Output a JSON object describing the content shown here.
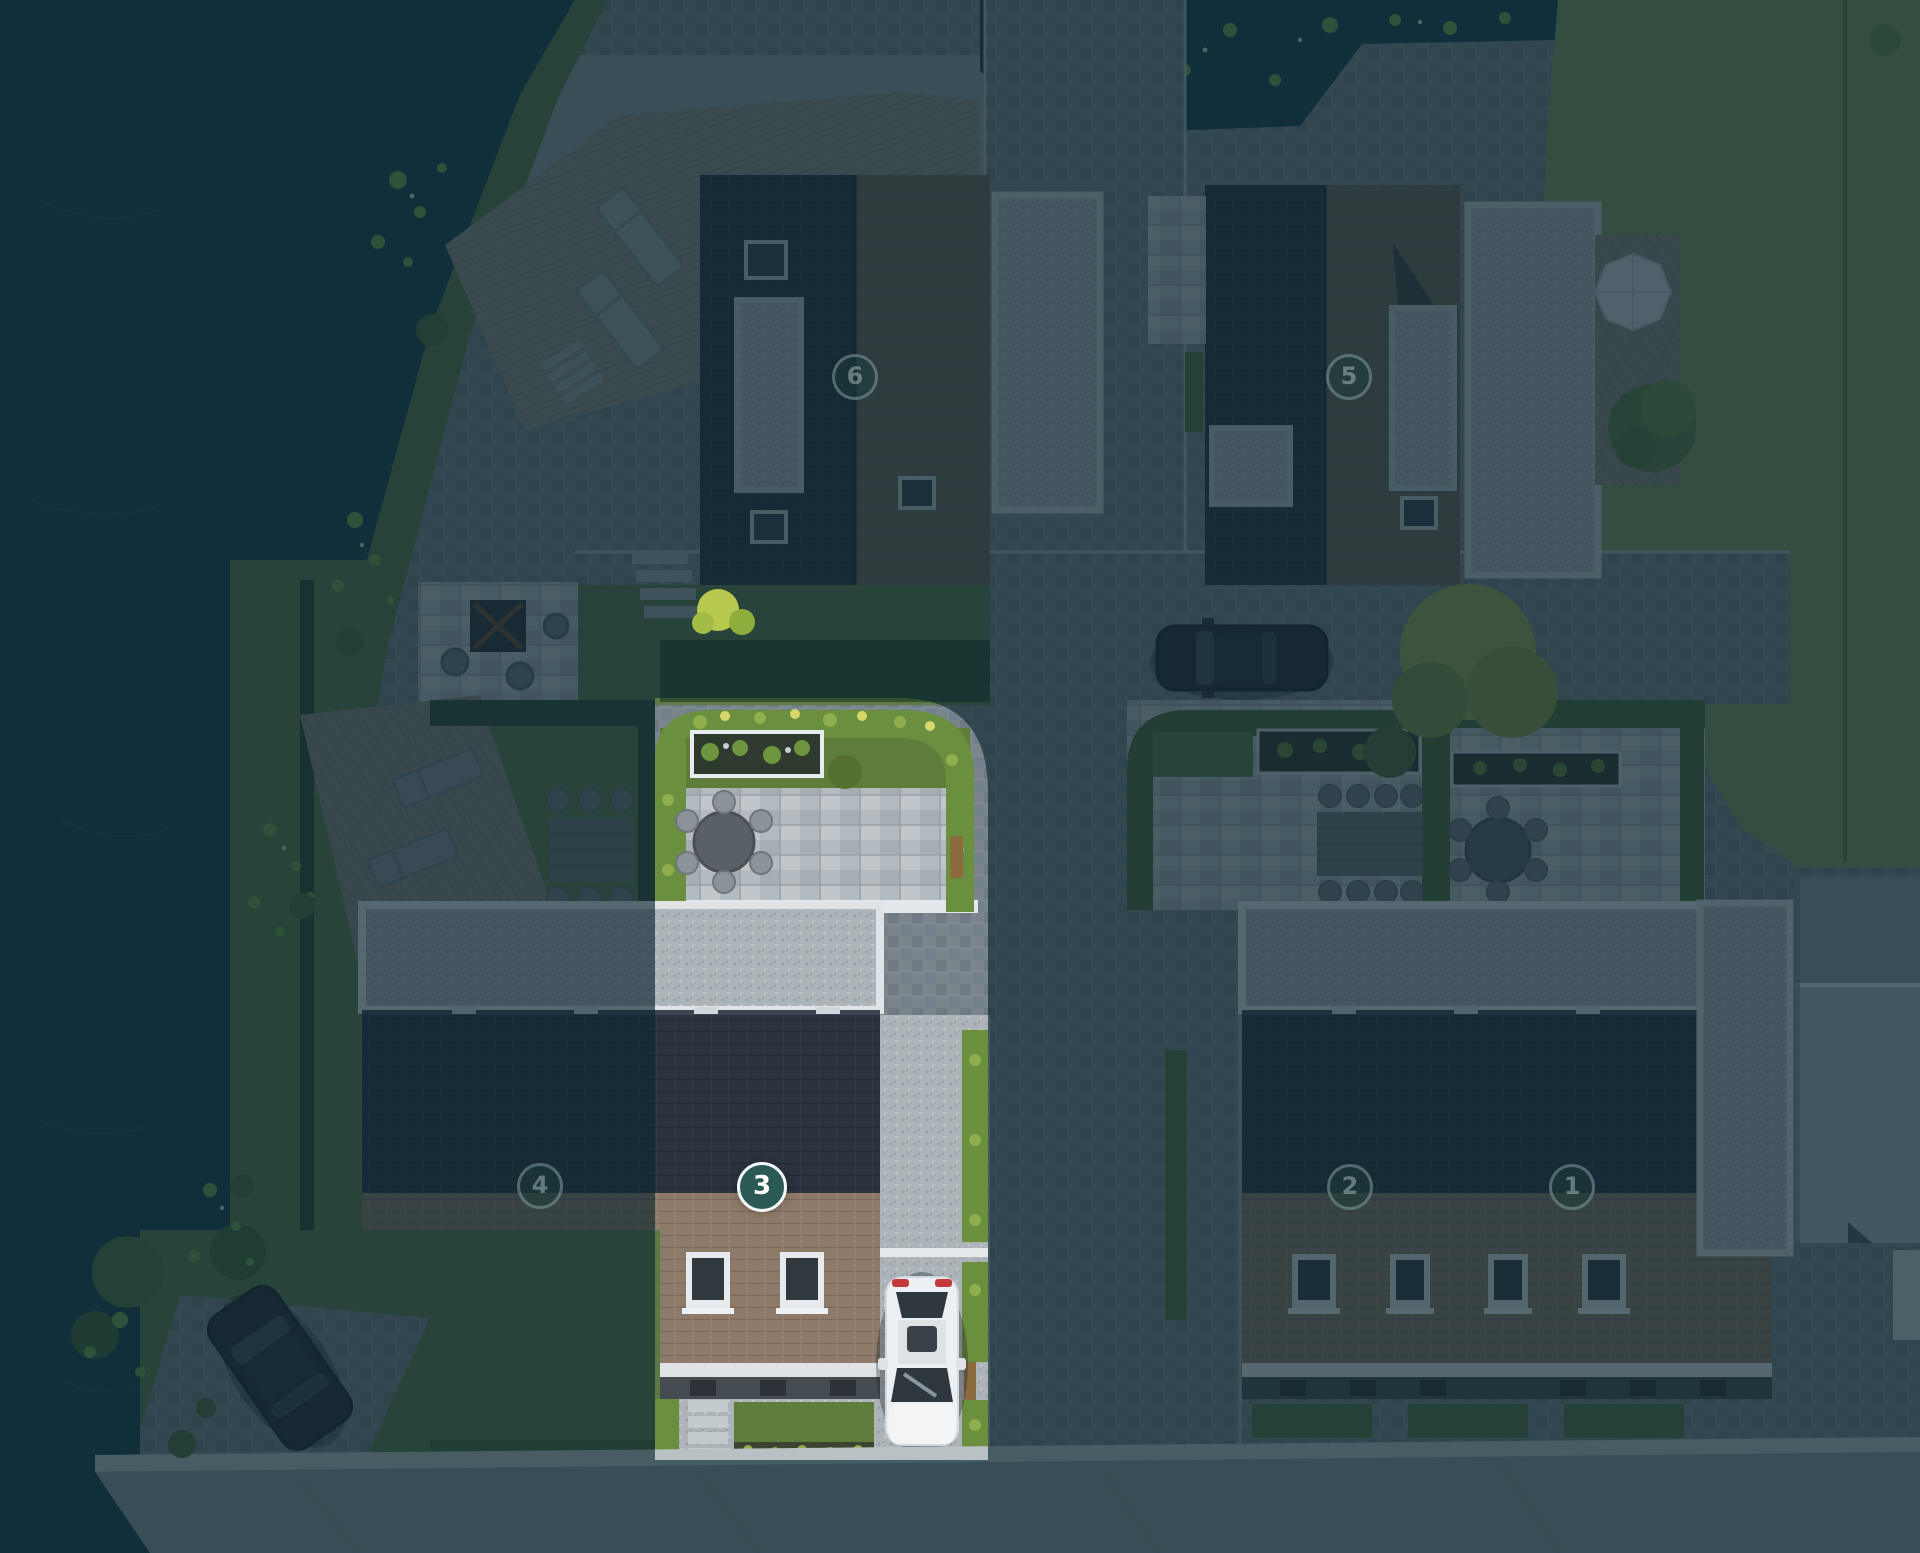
{
  "view": {
    "kind": "aerial-site-plan",
    "highlighted_plot": "3"
  },
  "markers": [
    {
      "label": "6",
      "state": "dimmed",
      "x_pct": 44.53,
      "y_pct": 24.28
    },
    {
      "label": "5",
      "state": "dimmed",
      "x_pct": 70.26,
      "y_pct": 24.28
    },
    {
      "label": "4",
      "state": "dimmed",
      "x_pct": 28.13,
      "y_pct": 76.37
    },
    {
      "label": "3",
      "state": "selected",
      "x_pct": 39.69,
      "y_pct": 76.43
    },
    {
      "label": "2",
      "state": "dimmed",
      "x_pct": 70.31,
      "y_pct": 76.43
    },
    {
      "label": "1",
      "state": "dimmed",
      "x_pct": 81.88,
      "y_pct": 76.43
    }
  ],
  "theme": {
    "selected_fill": "#2b5a55",
    "selected_border": "#f2f7f7",
    "selected_text": "#ffffff",
    "dimmed_fill": "rgba(28,60,58,0.55)",
    "dimmed_ring": "rgba(195,215,218,0.34)",
    "dimmed_text": "rgba(205,220,222,0.42)",
    "overlay_color": "rgba(14,40,50,0.66)"
  }
}
